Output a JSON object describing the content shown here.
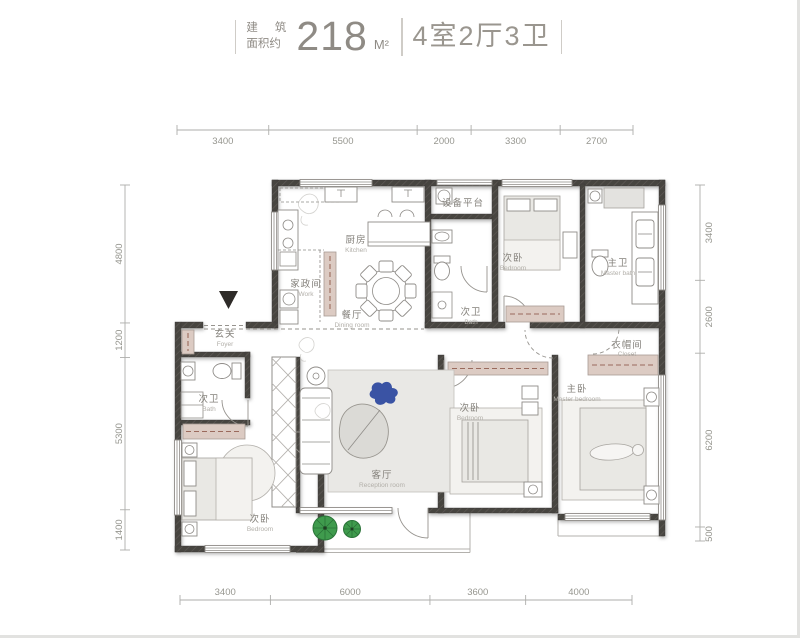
{
  "title": {
    "area_label_line1_a": "建",
    "area_label_line1_b": "筑",
    "area_label_line2": "面积约",
    "area_value": "218",
    "area_unit": "M²",
    "layout": "4室2厅3卫"
  },
  "dimensions": {
    "top": [
      "3400",
      "5500",
      "2000",
      "3300",
      "2700"
    ],
    "bottom": [
      "3400",
      "6000",
      "3600",
      "4000"
    ],
    "left": [
      "4800",
      "1200",
      "5300",
      "1400"
    ],
    "right": [
      "3400",
      "2600",
      "6200",
      "500"
    ]
  },
  "rooms": {
    "kitchen": {
      "cn": "厨房",
      "en": "Kitchen"
    },
    "work": {
      "cn": "家政间",
      "en": "Work"
    },
    "dining": {
      "cn": "餐厅",
      "en": "Dining room"
    },
    "equipment_platform": {
      "cn": "设备平台",
      "en": ""
    },
    "bedroom_top": {
      "cn": "次卧",
      "en": "Bedroom"
    },
    "master_bath": {
      "cn": "主卫",
      "en": "Master bath"
    },
    "bath_mid": {
      "cn": "次卫",
      "en": "Bath"
    },
    "foyer": {
      "cn": "玄关",
      "en": "Foyer"
    },
    "bath_left": {
      "cn": "次卫",
      "en": "Bath"
    },
    "bedroom_left": {
      "cn": "次卧",
      "en": "Bedroom"
    },
    "living": {
      "cn": "客厅",
      "en": "Reception room"
    },
    "bedroom_mid": {
      "cn": "次卧",
      "en": "Bedroom"
    },
    "master_bedroom": {
      "cn": "主卧",
      "en": "Master bedroom"
    },
    "closet": {
      "cn": "衣帽间",
      "en": "Closet"
    }
  },
  "colors": {
    "wall": "#474440",
    "wardrobe": "#dccbc3",
    "accent_blue": "#3a53a4",
    "plant_green": "#3f9b4d",
    "dimension_gray": "#96968f",
    "label_gray": "#85827c"
  }
}
